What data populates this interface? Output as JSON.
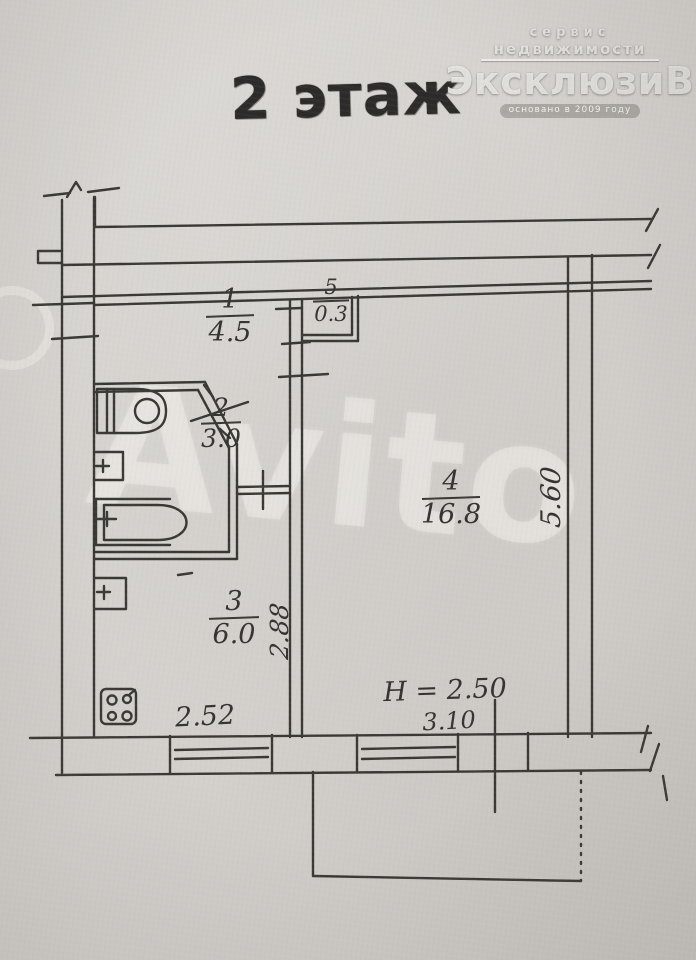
{
  "title": "2 этаж",
  "logo": {
    "line1": "сервис",
    "line2": "недвижимости",
    "name": "ЭксклюзиВ",
    "tagline": "основано в 2009 году"
  },
  "watermark": "Avito",
  "rooms": [
    {
      "id": "hallway",
      "number": "1",
      "area": "4.5"
    },
    {
      "id": "closet",
      "number": "5",
      "area": "0.3"
    },
    {
      "id": "bathroom",
      "number": "2",
      "area": "3.0"
    },
    {
      "id": "kitchen",
      "number": "3",
      "area": "6.0"
    },
    {
      "id": "living-room",
      "number": "4",
      "area": "16.8"
    }
  ],
  "dimensions": {
    "kitchen_width": "2.52",
    "kitchen_depth": "2.88",
    "living_width": "3.10",
    "living_depth": "5.60",
    "ceiling_height": "H = 2.50"
  },
  "colors": {
    "paper": "#d6d3cf",
    "ink": "#3a3833",
    "stamp": "#2d2b29",
    "watermark_tint": "#f3f1ec"
  }
}
